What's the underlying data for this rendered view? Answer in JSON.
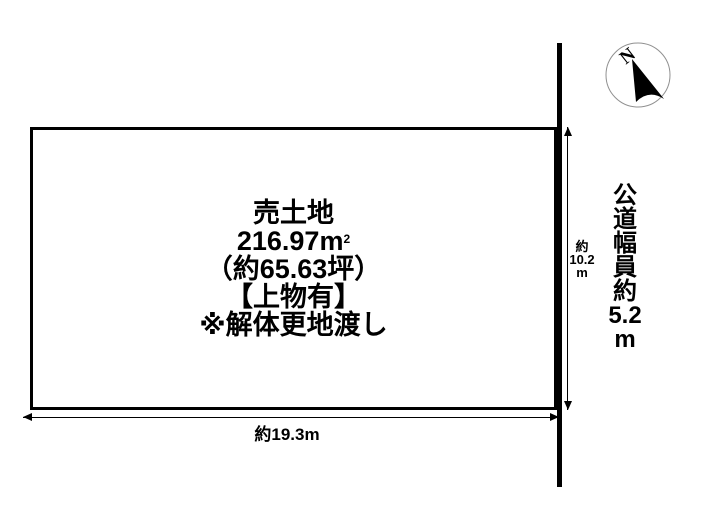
{
  "colors": {
    "line": "#000000",
    "background": "#ffffff",
    "compass_ring": "#909090"
  },
  "compass": {
    "label": "N"
  },
  "parcel": {
    "title": "売土地",
    "area_base": "216.97m",
    "area_sup": "2",
    "area_tsubo": "（約65.63坪）",
    "note_building": "【上物有】",
    "note_delivery": "※解体更地渡し"
  },
  "dimensions": {
    "width_label": "約19.3m",
    "depth_label_lines": [
      "約",
      "10.2",
      "m"
    ]
  },
  "road": {
    "caption_lines": [
      "公",
      "道",
      "幅",
      "員",
      "約",
      "5.2",
      "m"
    ]
  }
}
